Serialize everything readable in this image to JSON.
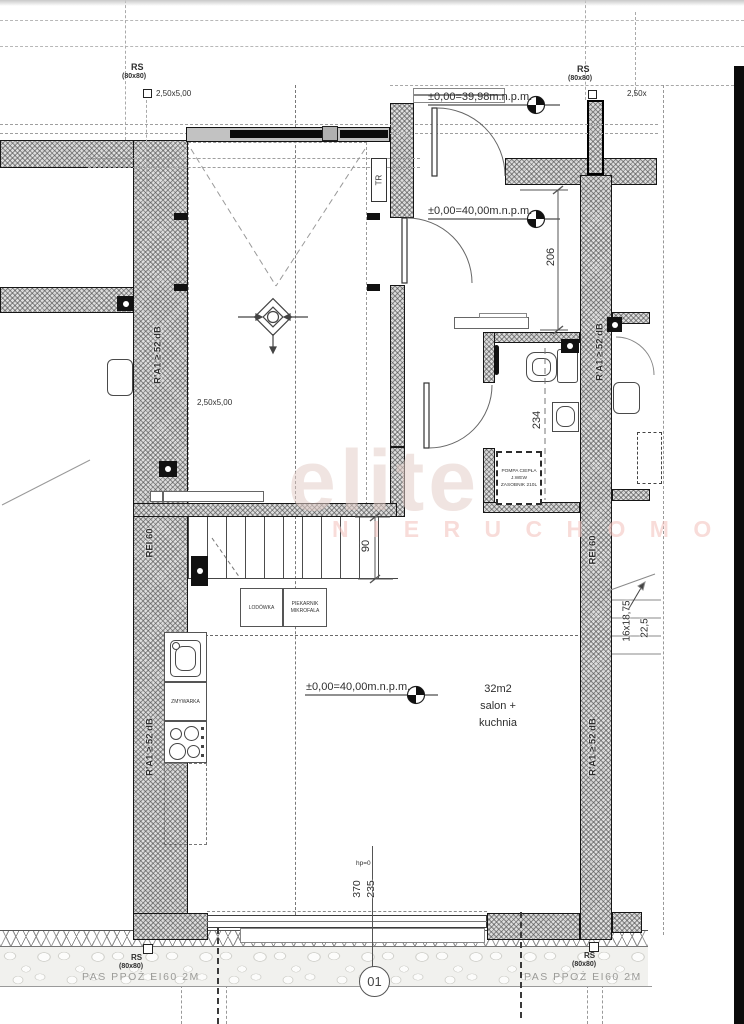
{
  "watermark": {
    "brand": "elite",
    "tagline": "N I E R U C H O M O Ś C I"
  },
  "axis_marker": "01",
  "riser": {
    "label": "RS",
    "size": "(80x80)"
  },
  "levels": {
    "outside": "±0,00=39,98m.n.p.m.",
    "entry": "±0,00=40,00m.n.p.m.",
    "living": "±0,00=40,00m.n.p.m."
  },
  "parking": {
    "space_left": "2,50x5,00",
    "space_garage": "2,50x5,00",
    "space_right": "2,50x"
  },
  "dims": {
    "hall_depth": "206",
    "bath_width": "234",
    "stair_width": "90",
    "neighbor_stairs": "16x18,75",
    "neighbor_stairs_riser": "22,5",
    "window_a": "370",
    "window_b": "235",
    "sill": "hp=0"
  },
  "wall_labels": {
    "acoustic": "R'A1 ≥ 52 dB",
    "fire": "REI 60",
    "fire_strip": "PAS PPOŻ EI60 2M"
  },
  "equipment": {
    "duct": "TR",
    "heat_pump_line1": "POMPA CIEPŁA",
    "heat_pump_line2": "J.WEW",
    "heat_pump_line3": "ZASOBNIK 210L",
    "fridge": "LODÓWKA",
    "oven_line1": "PIEKARNIK",
    "oven_line2": "MIKROFALA",
    "dishwasher": "ZMYWARKA"
  },
  "room": {
    "area": "32m2",
    "name_line1": "salon +",
    "name_line2": "kuchnia"
  }
}
